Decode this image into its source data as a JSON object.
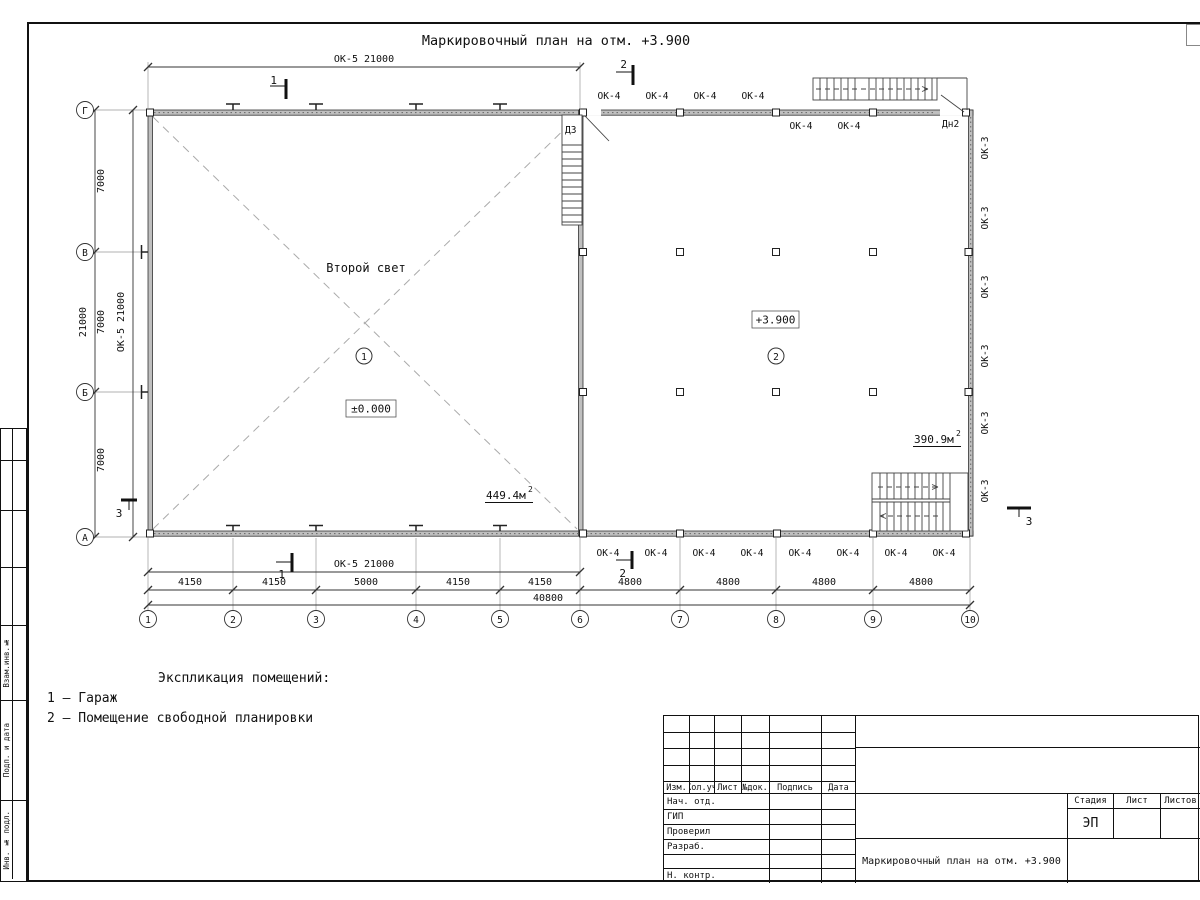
{
  "sheet": {
    "heading": "Маркировочный план на отм. +3.900"
  },
  "plan": {
    "labels": {
      "ok5": "ОК-5 21000",
      "ok4": "ОК-4",
      "ok3": "ОК-3",
      "d3": "Д3",
      "dn2": "Дн2",
      "second_light": "Второй свет",
      "level_zero": "±0.000",
      "level_high": "+3.900",
      "area1": "449.4м",
      "area1_sup": "2",
      "area2": "390.9м",
      "area2_sup": "2",
      "room1": "1",
      "room2": "2"
    },
    "dims": {
      "d7000": "7000",
      "d21000": "21000",
      "d4150": "4150",
      "d5000": "5000",
      "d4800": "4800",
      "d40800": "40800"
    },
    "axes": {
      "cols": [
        "1",
        "2",
        "3",
        "4",
        "5",
        "6",
        "7",
        "8",
        "9",
        "10"
      ],
      "rows": [
        "Г",
        "В",
        "Б",
        "А"
      ]
    },
    "sections": {
      "s1": "1",
      "s2": "2",
      "s3": "3"
    }
  },
  "legend": {
    "title": "Экспликация помещений:",
    "items": [
      "1 – Гараж",
      "2 – Помещение свободной планировки"
    ]
  },
  "titleblock": {
    "header_cols": [
      "Изм.",
      "Кол.уч",
      "Лист",
      "№док.",
      "Подпись",
      "Дата"
    ],
    "rows": [
      "Нач. отд.",
      "ГИП",
      "Проверил",
      "Разраб.",
      "",
      "Н. контр."
    ],
    "stage_label": "Стадия",
    "sheet_label": "Лист",
    "sheets_label": "Листов",
    "stage_value": "ЭП",
    "doc_title": "Маркировочный план на отм. +3.900"
  },
  "margin": {
    "boxes": [
      "Взам.инв.№",
      "Подп. и дата",
      "Инв. № подл."
    ]
  }
}
